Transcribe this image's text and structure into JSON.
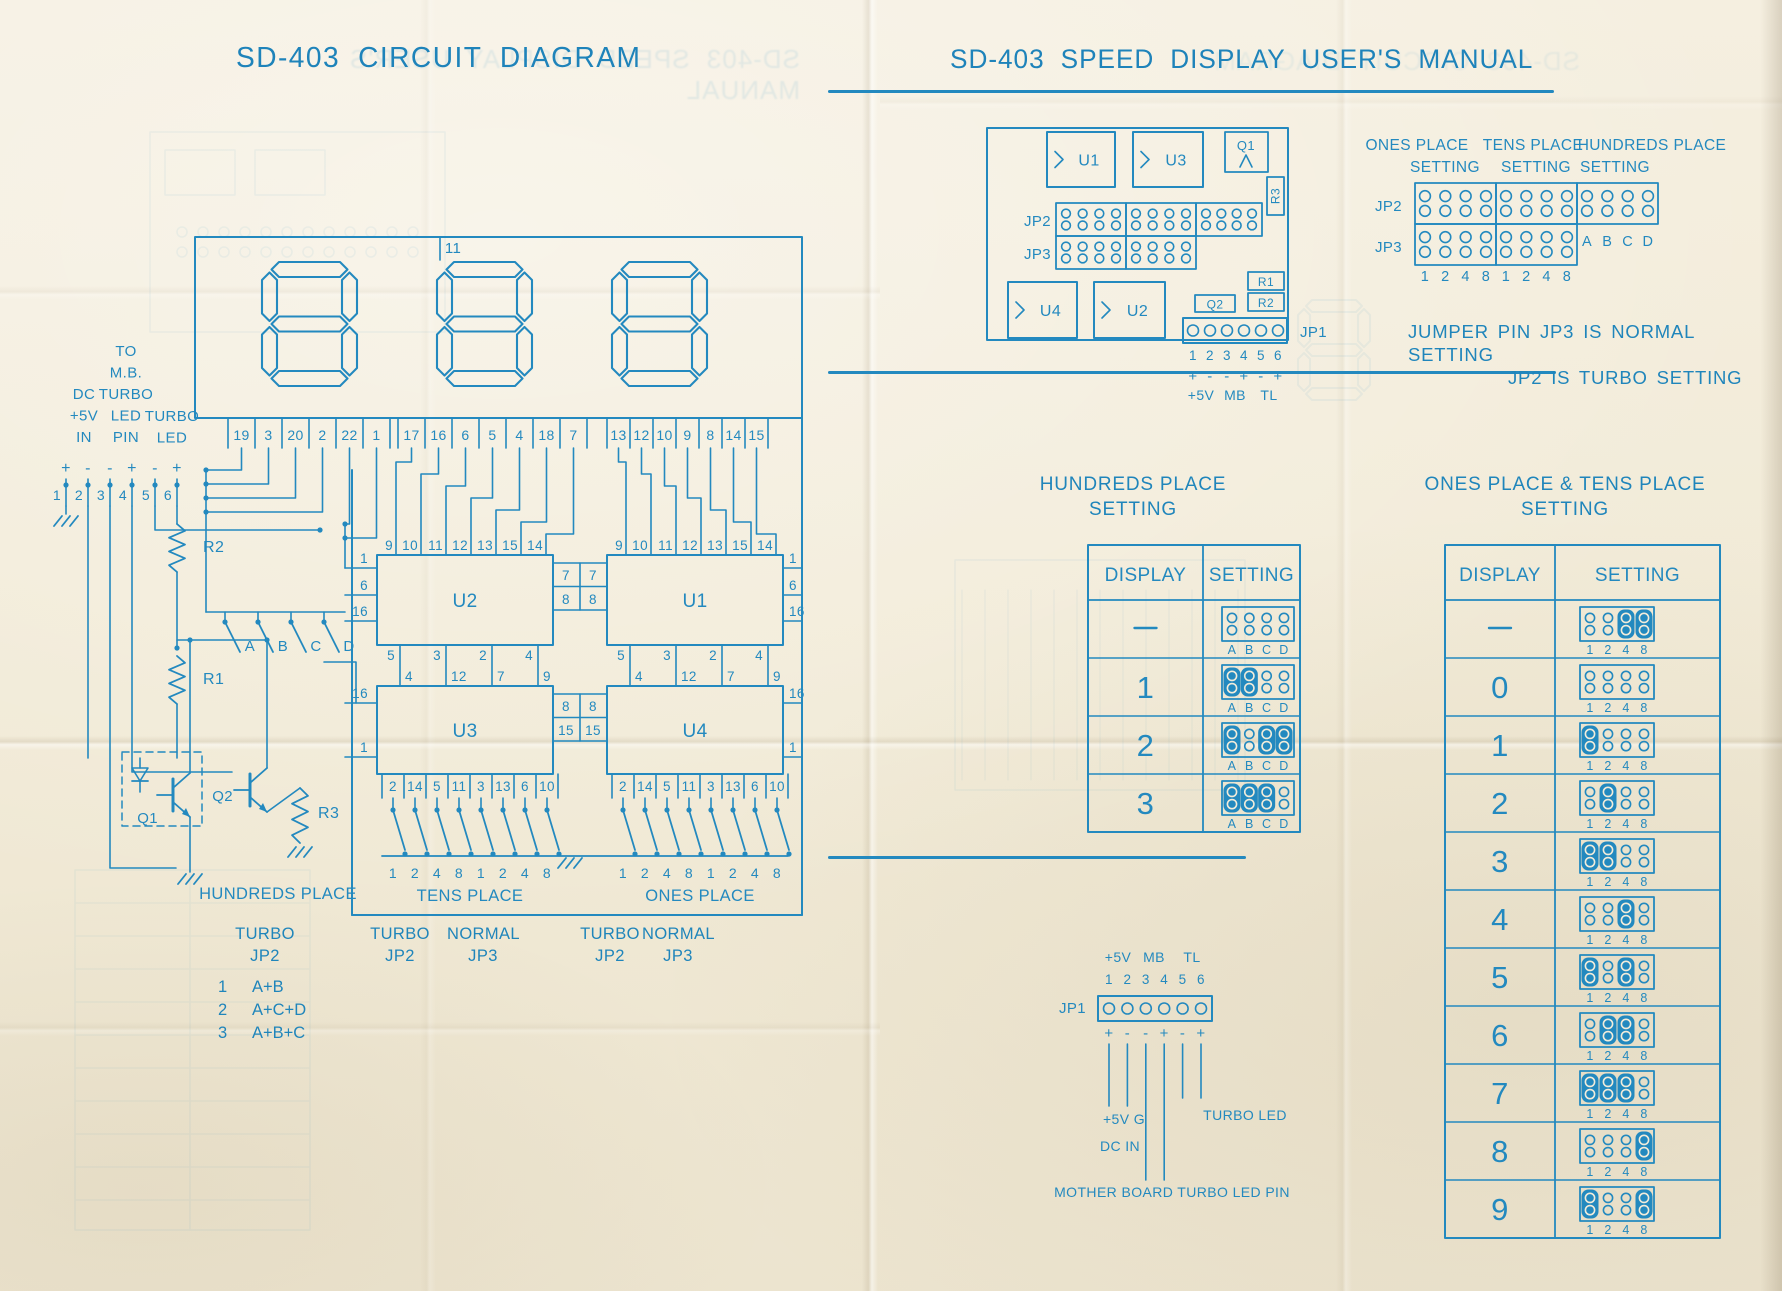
{
  "colors": {
    "ink": "#2389bf",
    "ink_dark": "#1f85bb",
    "paper": "#f2ecda"
  },
  "left": {
    "title": "SD-403 CIRCUIT DIAGRAM",
    "display": {
      "top_pin": "11",
      "pin_groups": [
        [
          "19",
          "3",
          "20",
          "2",
          "22",
          "1"
        ],
        [
          "17",
          "16",
          "6",
          "5",
          "4",
          "18",
          "7"
        ],
        [
          "13",
          "12",
          "10",
          "9",
          "8",
          "14",
          "15"
        ]
      ]
    },
    "connector": {
      "labels_col1": [
        "DC",
        "+5V",
        "IN"
      ],
      "labels_col2": [
        "TO",
        "M.B.",
        "TURBO",
        "LED",
        "PIN"
      ],
      "labels_col3": [
        "TURBO",
        "LED"
      ],
      "polarity": [
        "+",
        "-",
        "-",
        "+",
        "-",
        "+"
      ],
      "pins": [
        "1",
        "2",
        "3",
        "4",
        "5",
        "6"
      ]
    },
    "components": {
      "r1": "R1",
      "r2": "R2",
      "r3": "R3",
      "q1": "Q1",
      "q2": "Q2"
    },
    "switches": [
      "A",
      "B",
      "C",
      "D"
    ],
    "labels": {
      "hundreds": "HUNDREDS PLACE",
      "tens": "TENS PLACE",
      "ones": "ONES PLACE"
    },
    "chips": {
      "u2": {
        "label": "U2",
        "top": [
          "9",
          "10",
          "11",
          "12",
          "13",
          "15",
          "14"
        ],
        "left": [
          "1",
          "6",
          "16"
        ],
        "bottom": [
          "5",
          "3",
          "2",
          "4"
        ]
      },
      "u1": {
        "label": "U1",
        "top": [
          "9",
          "10",
          "11",
          "12",
          "13",
          "15",
          "14"
        ],
        "right": [
          "1",
          "6",
          "16"
        ],
        "bottom": [
          "5",
          "3",
          "2",
          "4"
        ]
      },
      "u3": {
        "label": "U3",
        "top": [
          "4",
          "12",
          "7",
          "9"
        ],
        "left": [
          "16",
          "1"
        ],
        "bottom": [
          "2",
          "14",
          "5",
          "11",
          "3",
          "13",
          "6",
          "10"
        ]
      },
      "u4": {
        "label": "U4",
        "top": [
          "4",
          "12",
          "7",
          "9"
        ],
        "right": [
          "16",
          "1"
        ],
        "bottom": [
          "2",
          "14",
          "5",
          "11",
          "3",
          "13",
          "6",
          "10"
        ]
      },
      "mid_u2u1": [
        [
          "7",
          "7"
        ],
        [
          "8",
          "8"
        ]
      ],
      "mid_u3u4": [
        [
          "8",
          "8"
        ],
        [
          "15",
          "15"
        ]
      ]
    },
    "bank_bits": [
      "1",
      "2",
      "4",
      "8",
      "1",
      "2",
      "4",
      "8"
    ],
    "legend": {
      "h1": "TURBO",
      "h2": "JP2",
      "h_rows": [
        {
          "n": "1",
          "f": "A+B"
        },
        {
          "n": "2",
          "f": "A+C+D"
        },
        {
          "n": "3",
          "f": "A+B+C"
        }
      ],
      "tens_t1": "TURBO",
      "tens_t2": "JP2",
      "tens_n1": "NORMAL",
      "tens_n2": "JP3",
      "ones_t1": "TURBO",
      "ones_t2": "JP2",
      "ones_n1": "NORMAL",
      "ones_n2": "JP3"
    }
  },
  "right": {
    "title": "SD-403 SPEED DISPLAY USER'S MANUAL",
    "board": {
      "u1": "U1",
      "u3": "U3",
      "u4": "U4",
      "u2": "U2",
      "q1": "Q1",
      "q2": "Q2",
      "r1": "R1",
      "r2": "R2",
      "r3": "R3",
      "jp2": "JP2",
      "jp3": "JP3",
      "jp1": "JP1",
      "jp1_pins": [
        "1",
        "2",
        "3",
        "4",
        "5",
        "6"
      ],
      "jp1_polarity": [
        "+",
        "-",
        "-",
        "+",
        "-",
        "+"
      ],
      "jp1_labels": [
        "+5V",
        "MB",
        "TL"
      ]
    },
    "map": {
      "headers": [
        [
          "ONES PLACE",
          "SETTING"
        ],
        [
          "TENS PLACE",
          "SETTING"
        ],
        [
          "HUNDREDS PLACE",
          "SETTING"
        ]
      ],
      "jp2": "JP2",
      "jp3": "JP3",
      "abcd": [
        "A",
        "B",
        "C",
        "D"
      ],
      "bits": [
        "1",
        "2",
        "4",
        "8",
        "1",
        "2",
        "4",
        "8"
      ]
    },
    "note1": "JUMPER PIN JP3 IS NORMAL SETTING",
    "note2": "JP2 IS TURBO SETTING",
    "hundreds_table": {
      "title1": "HUNDREDS PLACE",
      "title2": "SETTING",
      "col1": "DISPLAY",
      "col2": "SETTING",
      "pins": [
        "A",
        "B",
        "C",
        "D"
      ],
      "rows": [
        {
          "d": "-",
          "j": []
        },
        {
          "d": "1",
          "j": [
            0,
            1
          ]
        },
        {
          "d": "2",
          "j": [
            0,
            2,
            3
          ]
        },
        {
          "d": "3",
          "j": [
            0,
            1,
            2
          ]
        }
      ]
    },
    "ones_table": {
      "title1": "ONES PLACE & TENS PLACE",
      "title2": "SETTING",
      "col1": "DISPLAY",
      "col2": "SETTING",
      "pins": [
        "1",
        "2",
        "4",
        "8"
      ],
      "rows": [
        {
          "d": "-",
          "j": [
            2,
            3
          ]
        },
        {
          "d": "0",
          "j": []
        },
        {
          "d": "1",
          "j": [
            0
          ]
        },
        {
          "d": "2",
          "j": [
            1
          ]
        },
        {
          "d": "3",
          "j": [
            0,
            1
          ]
        },
        {
          "d": "4",
          "j": [
            2
          ]
        },
        {
          "d": "5",
          "j": [
            0,
            2
          ]
        },
        {
          "d": "6",
          "j": [
            1,
            2
          ]
        },
        {
          "d": "7",
          "j": [
            0,
            1,
            2
          ]
        },
        {
          "d": "8",
          "j": [
            3
          ]
        },
        {
          "d": "9",
          "j": [
            0,
            3
          ]
        }
      ]
    },
    "jp1d": {
      "top": [
        "+5V",
        "MB",
        "TL"
      ],
      "pins": [
        "1",
        "2",
        "3",
        "4",
        "5",
        "6"
      ],
      "label": "JP1",
      "polarity": [
        "+",
        "-",
        "-",
        "+",
        "-",
        "+"
      ],
      "l_5vg": "+5V G",
      "l_turbo": "TURBO LED",
      "l_dcin": "DC IN",
      "l_mb": "MOTHER BOARD TURBO LED PIN"
    }
  }
}
